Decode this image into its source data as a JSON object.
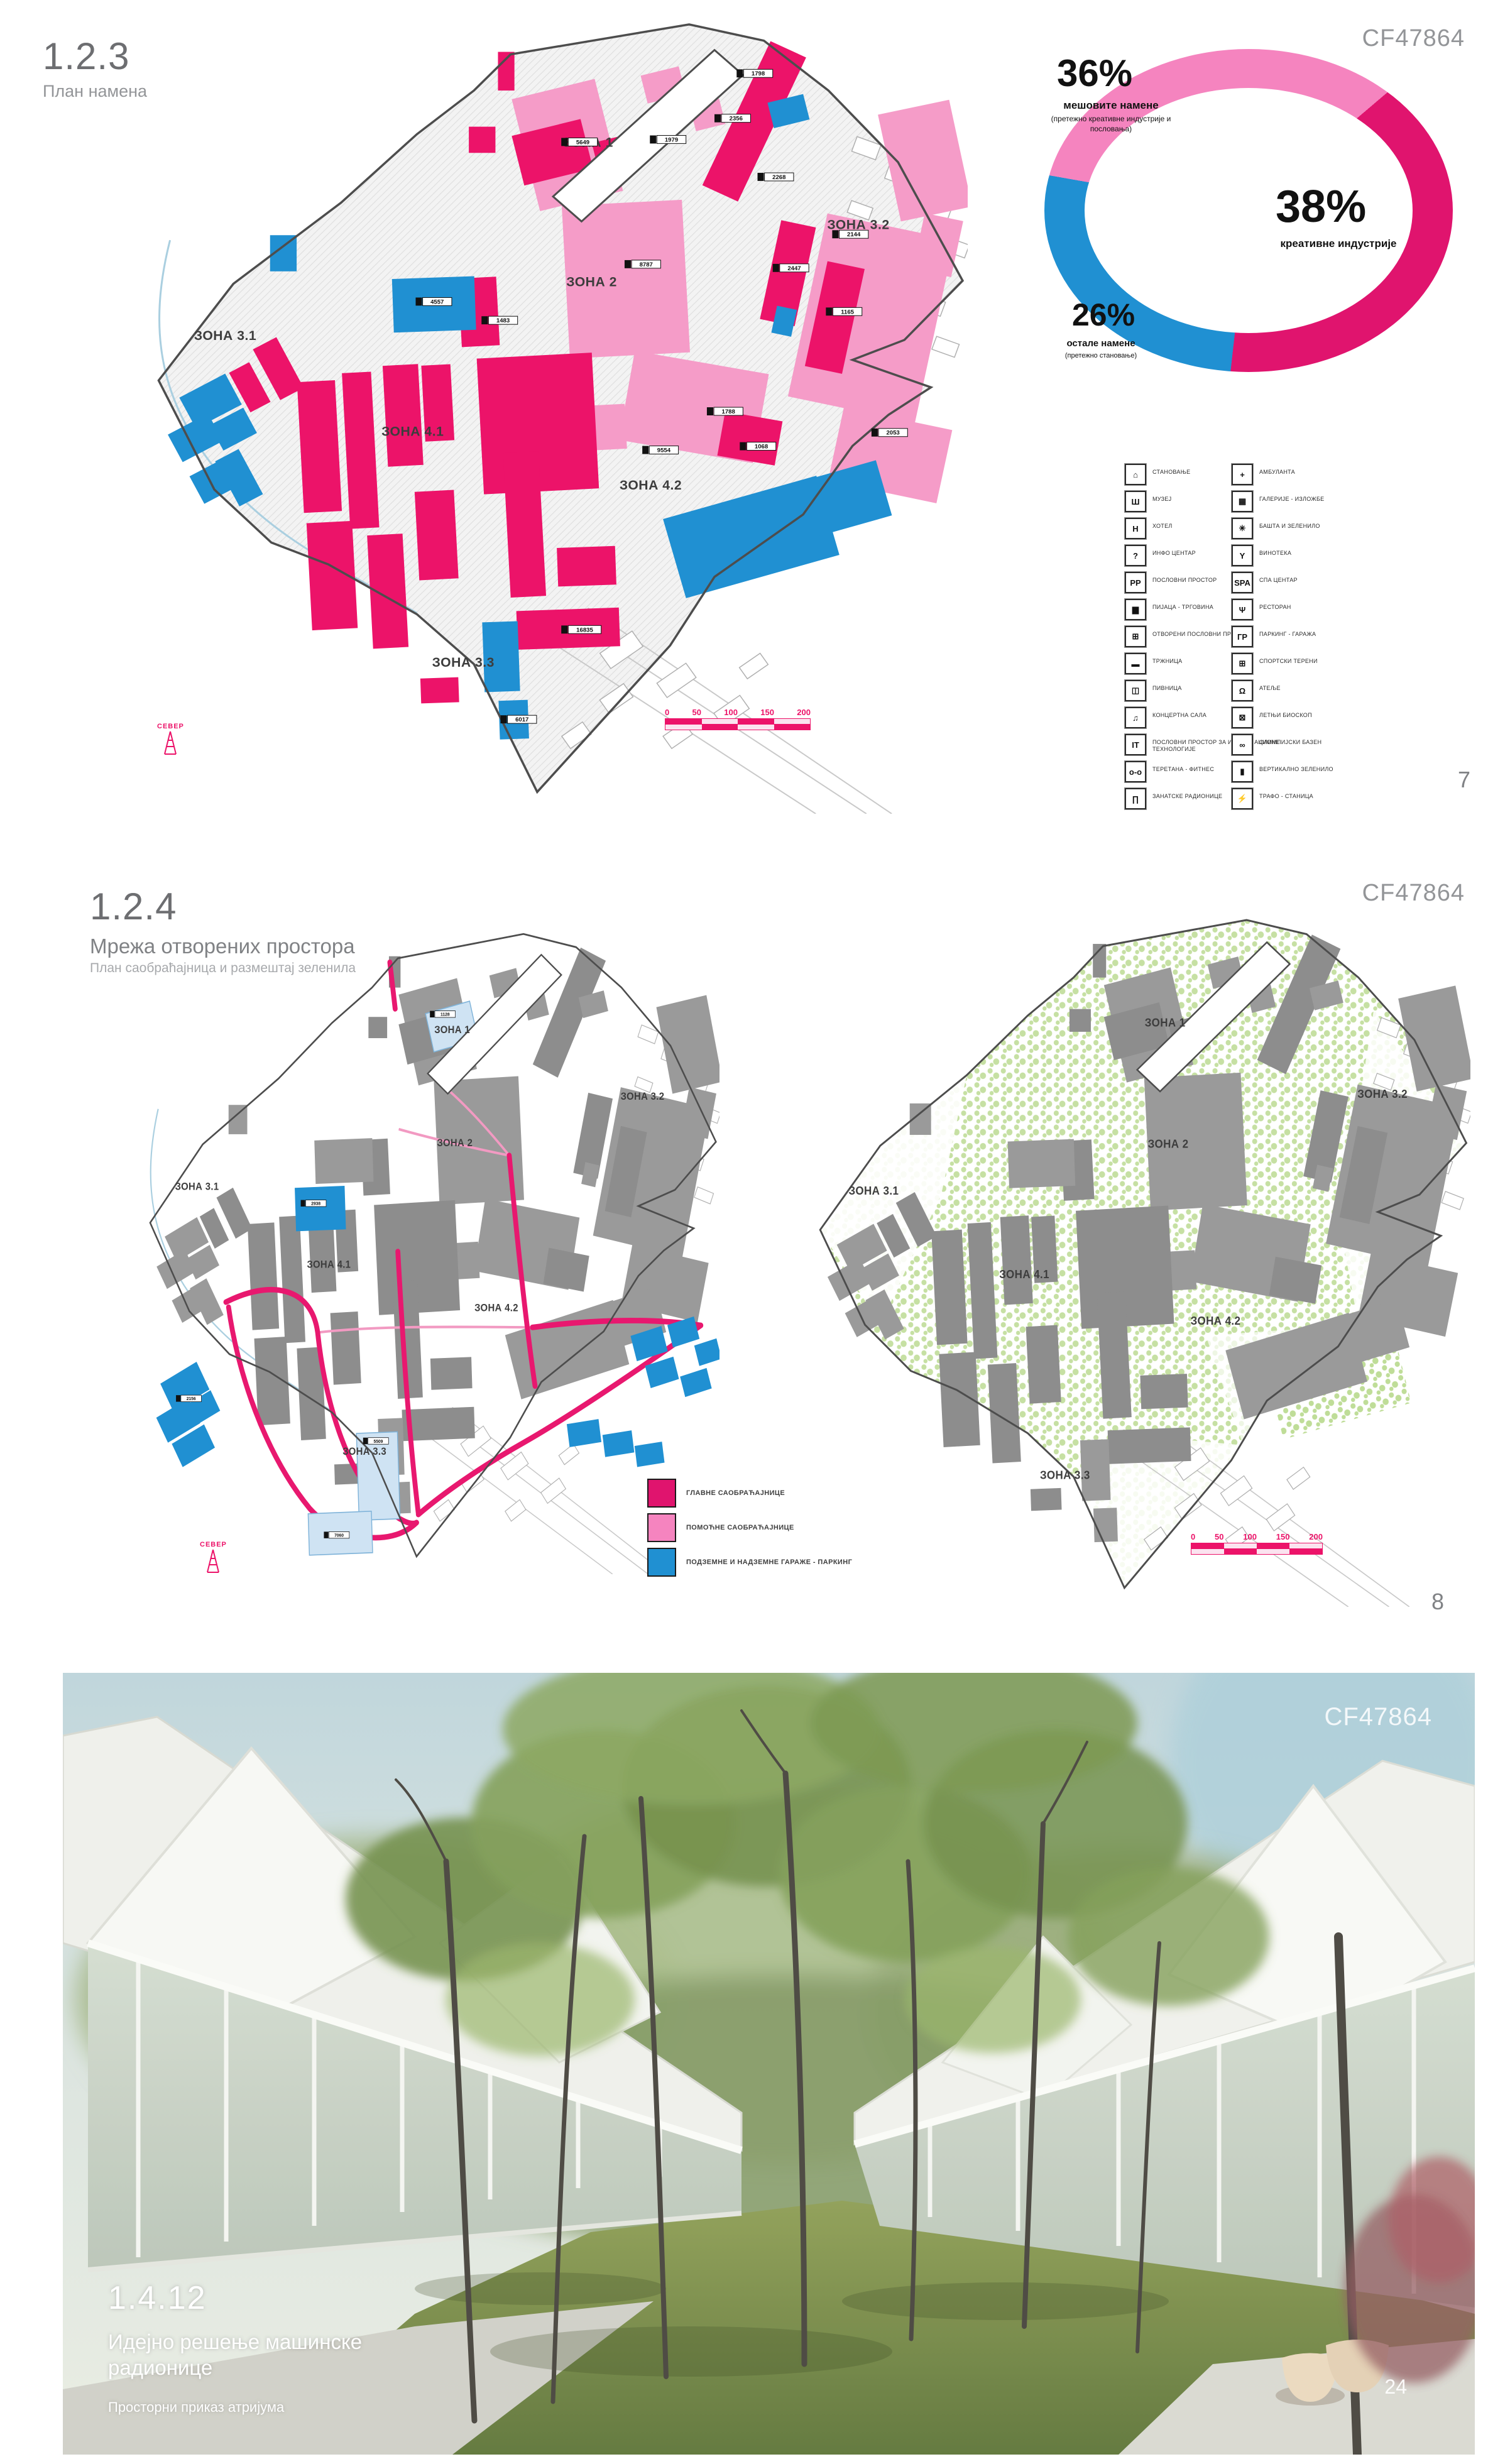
{
  "zones": [
    "ЗОНА 1",
    "ЗОНА 2",
    "ЗОНА 3.1",
    "ЗОНА 3.2",
    "ЗОНА 4.1",
    "ЗОНА 4.2",
    "ЗОНА 3.3"
  ],
  "s1": {
    "number": "1.2.3",
    "title": "План намена",
    "code": "CF47864",
    "page_no": "7",
    "north": "СЕВЕР",
    "scale": [
      "0",
      "50",
      "100",
      "150",
      "200"
    ],
    "donut": {
      "p36": {
        "pct": "36%",
        "label": "мешовите намене",
        "sub1": "(претежно креативне индустрије и",
        "sub2": "пословања)"
      },
      "p38": {
        "pct": "38%",
        "label": "креативне индустрије"
      },
      "p26": {
        "pct": "26%",
        "label": "остале намене",
        "sub1": "(претежно становање)"
      }
    },
    "tags": [
      "1798",
      "2356",
      "5649",
      "1979",
      "2268",
      "2447",
      "2144",
      "1165",
      "8787",
      "4557",
      "1483",
      "2053",
      "1788",
      "9554",
      "1068",
      "16835",
      "6017"
    ],
    "legend_left": [
      {
        "icon": "⌂",
        "label": "СТАНОВАЊЕ"
      },
      {
        "icon": "Ш",
        "label": "МУЗЕЈ"
      },
      {
        "icon": "H",
        "label": "ХОТЕЛ"
      },
      {
        "icon": "?",
        "label": "ИНФО ЦЕНТАР"
      },
      {
        "icon": "PP",
        "label": "ПОСЛОВНИ ПРОСТОР"
      },
      {
        "icon": "▆",
        "label": "ПИЈАЦА - ТРГОВИНА"
      },
      {
        "icon": "⊞",
        "label": "ОТВОРЕНИ ПОСЛОВНИ ПРОСТОР"
      },
      {
        "icon": "▬",
        "label": "ТРЖНИЦА"
      },
      {
        "icon": "◫",
        "label": "ПИВНИЦА"
      },
      {
        "icon": "♫",
        "label": "КОНЦЕРТНА САЛА"
      },
      {
        "icon": "IT",
        "label": "ПОСЛОВНИ ПРОСТОР ЗА ИНФОРМАЦИОНЕ ТЕХНОЛОГИЈЕ"
      },
      {
        "icon": "о-о",
        "label": "ТЕРЕТАНА - ФИТНЕС"
      },
      {
        "icon": "∏",
        "label": "ЗАНАТСКЕ РАДИОНИЦЕ"
      }
    ],
    "legend_right": [
      {
        "icon": "+",
        "label": "АМБУЛАНТА"
      },
      {
        "icon": "▦",
        "label": "ГАЛЕРИЈЕ - ИЗЛОЖБЕ"
      },
      {
        "icon": "✳",
        "label": "БАШТА И ЗЕЛЕНИЛО"
      },
      {
        "icon": "Y",
        "label": "ВИНОТЕКА"
      },
      {
        "icon": "SPA",
        "label": "СПА ЦЕНТАР"
      },
      {
        "icon": "Ψ",
        "label": "РЕСТОРАН"
      },
      {
        "icon": "ГР",
        "label": "ПАРКИНГ - ГАРАЖА"
      },
      {
        "icon": "⊞",
        "label": "СПОРТСКИ ТЕРЕНИ"
      },
      {
        "icon": "Ω",
        "label": "АТЕЉЕ"
      },
      {
        "icon": "⊠",
        "label": "ЛЕТЊИ БИОСКОП"
      },
      {
        "icon": "∞",
        "label": "ОЛИМПИЈСКИ БАЗЕН"
      },
      {
        "icon": "▮",
        "label": "ВЕРТИКАЛНО ЗЕЛЕНИЛО"
      },
      {
        "icon": "⚡",
        "label": "ТРАФО - СТАНИЦА"
      }
    ]
  },
  "s2": {
    "number": "1.2.4",
    "title": "Мрежа отворених простора",
    "subtitle": "План саобраћајница и размештај зеленила",
    "code": "CF47864",
    "page_no": "8",
    "north": "СЕВЕР",
    "scale": [
      "0",
      "50",
      "100",
      "150",
      "200"
    ],
    "tags": [
      "1128",
      "2938",
      "5509",
      "7060",
      "2156"
    ],
    "legend": [
      {
        "label": "ГЛАВНЕ САОБРАЋАЈНИЦЕ",
        "color": "#e0146e"
      },
      {
        "label": "ПОМОЋНЕ САОБРАЋАЈНИЦЕ",
        "color": "#f584bf"
      },
      {
        "label": "ПОДЗЕМНЕ И НАДЗЕМНЕ ГАРАЖЕ - ПАРКИНГ",
        "color": "#2090d2"
      }
    ]
  },
  "s3": {
    "number": "1.4.12",
    "title_line1": "Идејно решење машинске",
    "title_line2": "радионице",
    "subtitle": "Просторни приказ атријума",
    "code": "CF47864",
    "page_no": "24"
  },
  "chart_data": {
    "type": "pie",
    "title": "План намена - структура намена",
    "labels": [
      "мешовите намене (претежно креативне индустрије и пословања)",
      "креативне индустрије",
      "остале намене (претежно становање)"
    ],
    "values": [
      36,
      38,
      26
    ],
    "colors": [
      "#f584bf",
      "#e0146e",
      "#2090d2"
    ],
    "hole": true,
    "legend_position": "around"
  }
}
